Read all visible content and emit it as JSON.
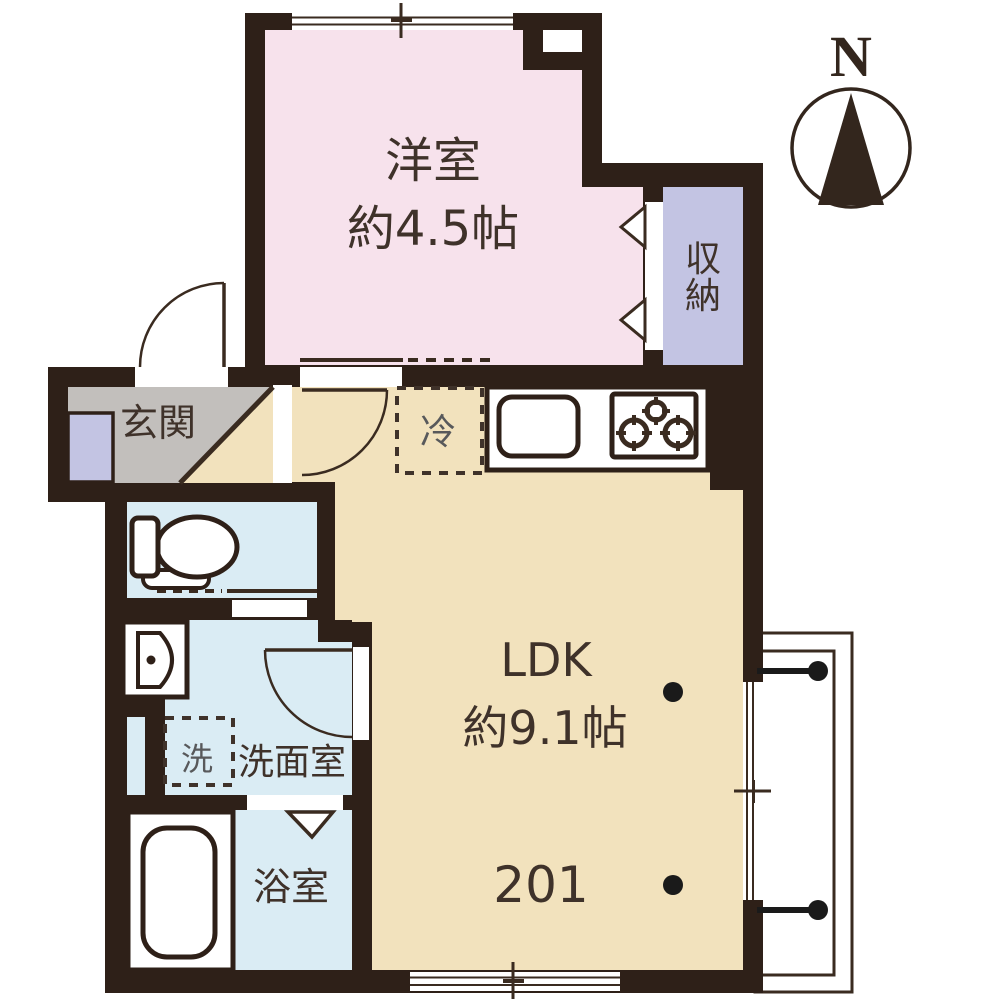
{
  "unit": {
    "number": "201"
  },
  "compass": {
    "north_label": "N"
  },
  "rooms": {
    "western_room": {
      "name": "洋室",
      "size": "約4.5帖"
    },
    "ldk": {
      "name": "LDK",
      "size": "約9.1帖"
    },
    "storage": {
      "name": "収納",
      "chars": [
        "収",
        "納"
      ]
    },
    "entrance": {
      "name": "玄関"
    },
    "washroom": {
      "name": "洗面室"
    },
    "bathroom": {
      "name": "浴室"
    }
  },
  "fixtures": {
    "refrigerator": {
      "label": "冷"
    },
    "washing_machine": {
      "label": "洗"
    }
  },
  "colors": {
    "wall": "#2e2018",
    "western_room_floor": "#f7e2ec",
    "ldk_floor": "#f2e2bd",
    "storage_floor": "#c3c4e3",
    "entrance_floor": "#c2bfbc",
    "wet_area_floor": "#daecf4",
    "line": "#3a2b20",
    "text": "#3f322a",
    "muted_text": "#58595b"
  }
}
